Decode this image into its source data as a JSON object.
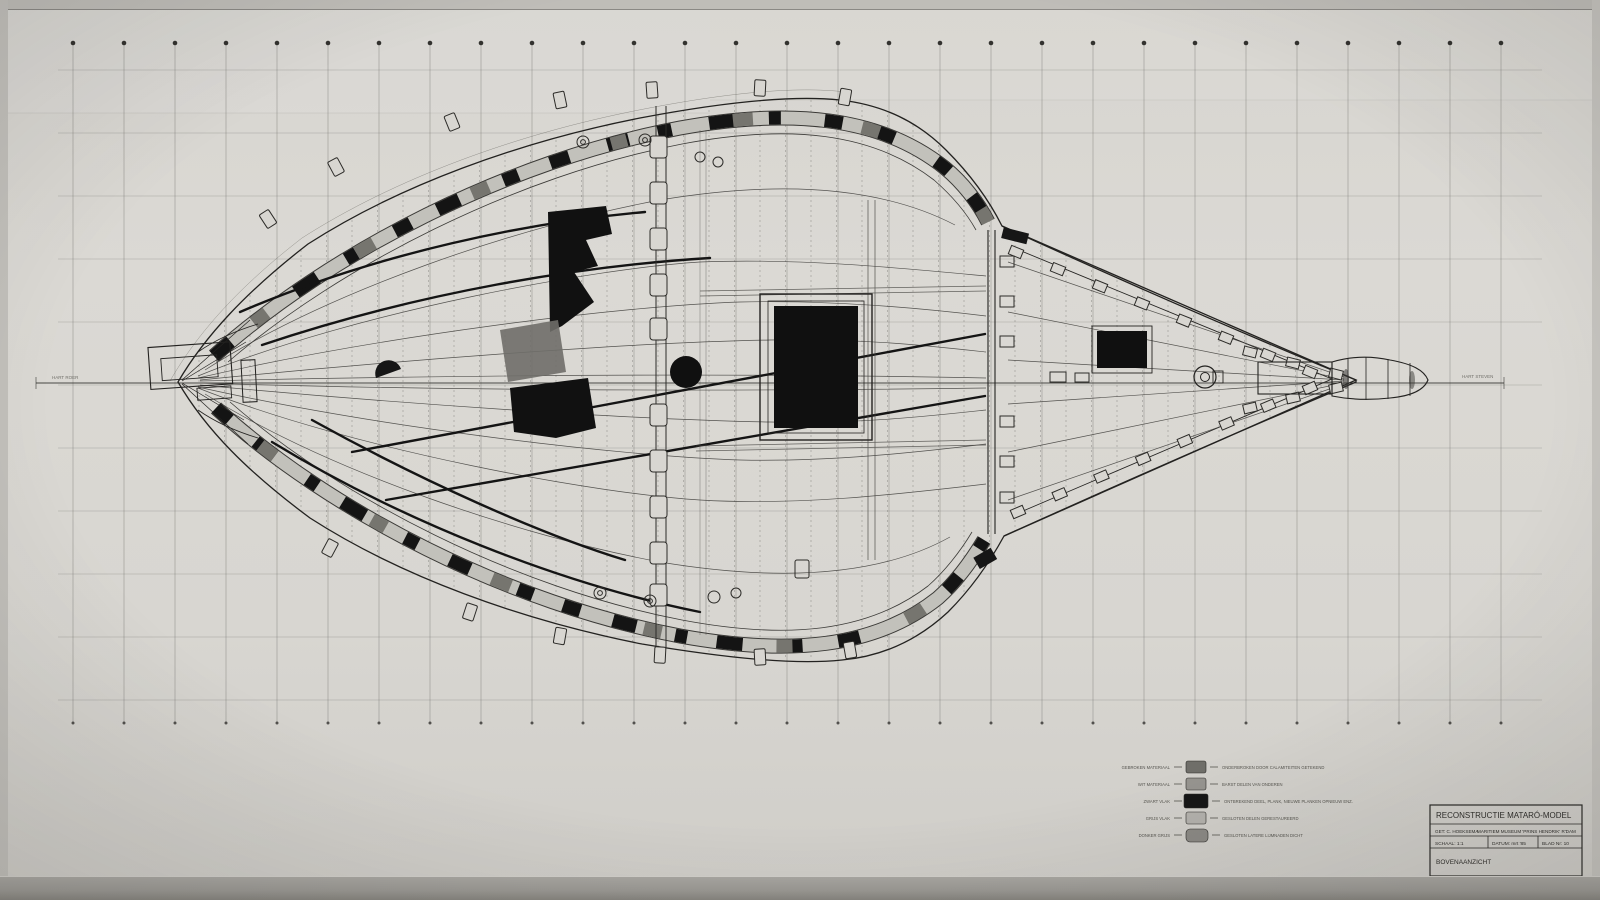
{
  "document": {
    "kind": "technical reconstruction drawing, top view of a ship model",
    "sheet_note": "pencil/ink drawing on gridded paper, photographed under glass"
  },
  "colors": {
    "paper": "#d8d6d1",
    "paper_dark_edge": "#a9a7a2",
    "ink": "#1d1c1a",
    "ink_medium": "#55544f",
    "ink_faint": "#8a8984",
    "band_base": "#c2c1bb",
    "band_dark": "#141414",
    "band_gray": "#76756f"
  },
  "grid": {
    "station_count": 29,
    "station_x0": 73,
    "station_dx": 51,
    "station_top": 45,
    "station_bottom": 723,
    "row_count": 11,
    "row_y0": 70,
    "row_dy": 63,
    "row_x0": 58,
    "row_x1": 1542
  },
  "title_block": {
    "title": "RECONSTRUCTIE  MATARÓ-MODEL",
    "drawn_by": "GET: C. HOEKSEMA",
    "institution": "MARITIEM MUSEUM 'PRINS HENDRIK' R'DAM",
    "scale": "SCHAAL: 1:1",
    "date": "DATUM: mrt '85",
    "sheet": "BLAD Nr: 10",
    "view": "BOVENAANZICHT"
  },
  "legend": {
    "rows": [
      {
        "label": "GEBROKEN MATERIAAL",
        "swatch": "#6f6e69",
        "desc": "ONDERBROKEN DOOR CALAMITEITEN GETEKEND"
      },
      {
        "label": "WIT MATERIAAL",
        "swatch": "#96948f",
        "desc": "BARST DELEN VAN ONDEREN"
      },
      {
        "label": "ZWART VLAK",
        "swatch": "#161616",
        "desc": "ONTBREKEND DEEL, PLANK, NIEUWE PLANKEN OPNIEUW ENZ."
      },
      {
        "label": "GRIJS VLAK",
        "swatch": "#b3b1ac",
        "desc": "GESLOTEN DELEN GERESTAUREERD"
      },
      {
        "label": "DONKER GRIJS",
        "swatch": "#8b8984",
        "desc": "GESLOTEN LATERE LIJMNADEN DICHT"
      }
    ]
  },
  "annotations": {
    "centerline_left": "HART ROER",
    "centerline_right": "HART STEVEN",
    "handwritten": "T 3418"
  }
}
